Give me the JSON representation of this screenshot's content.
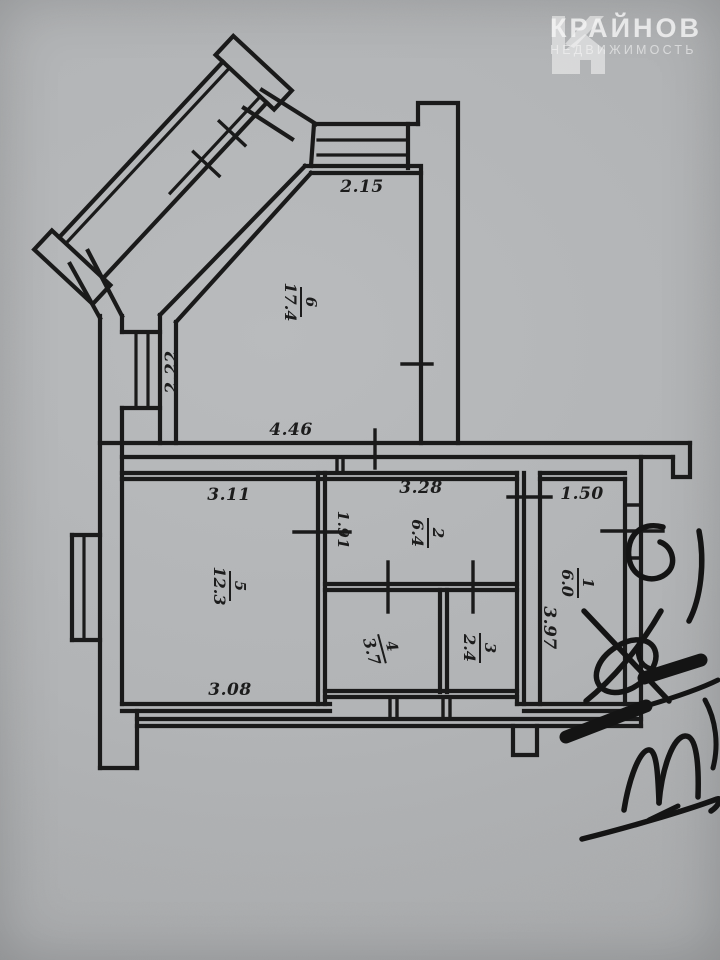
{
  "logo": {
    "brand": "КРАЙНОВ",
    "tagline": "НЕДВИЖИМОСТЬ",
    "icon": "house-k-logo-icon"
  },
  "floor_plan": {
    "rooms": [
      {
        "number": "6",
        "area": "17.4"
      },
      {
        "number": "5",
        "area": "12.3"
      },
      {
        "number": "2",
        "area": "6.4"
      },
      {
        "number": "4",
        "area": "3.7"
      },
      {
        "number": "3",
        "area": "2.4"
      },
      {
        "number": "1",
        "area": "6.0"
      }
    ],
    "dimensions": {
      "top_window": "2.15",
      "left_window": "2.22",
      "hall_bottom": "4.46",
      "room5_top": "3.11",
      "room2_top": "3.28",
      "room1_top": "1.50",
      "room2_left": "1.91",
      "room1_left": "3.97",
      "room5_bottom": "3.08"
    }
  },
  "colors": {
    "paper": "#b2b4b6",
    "ink": "#1a1a1a",
    "logo_text": "#fafafa"
  }
}
